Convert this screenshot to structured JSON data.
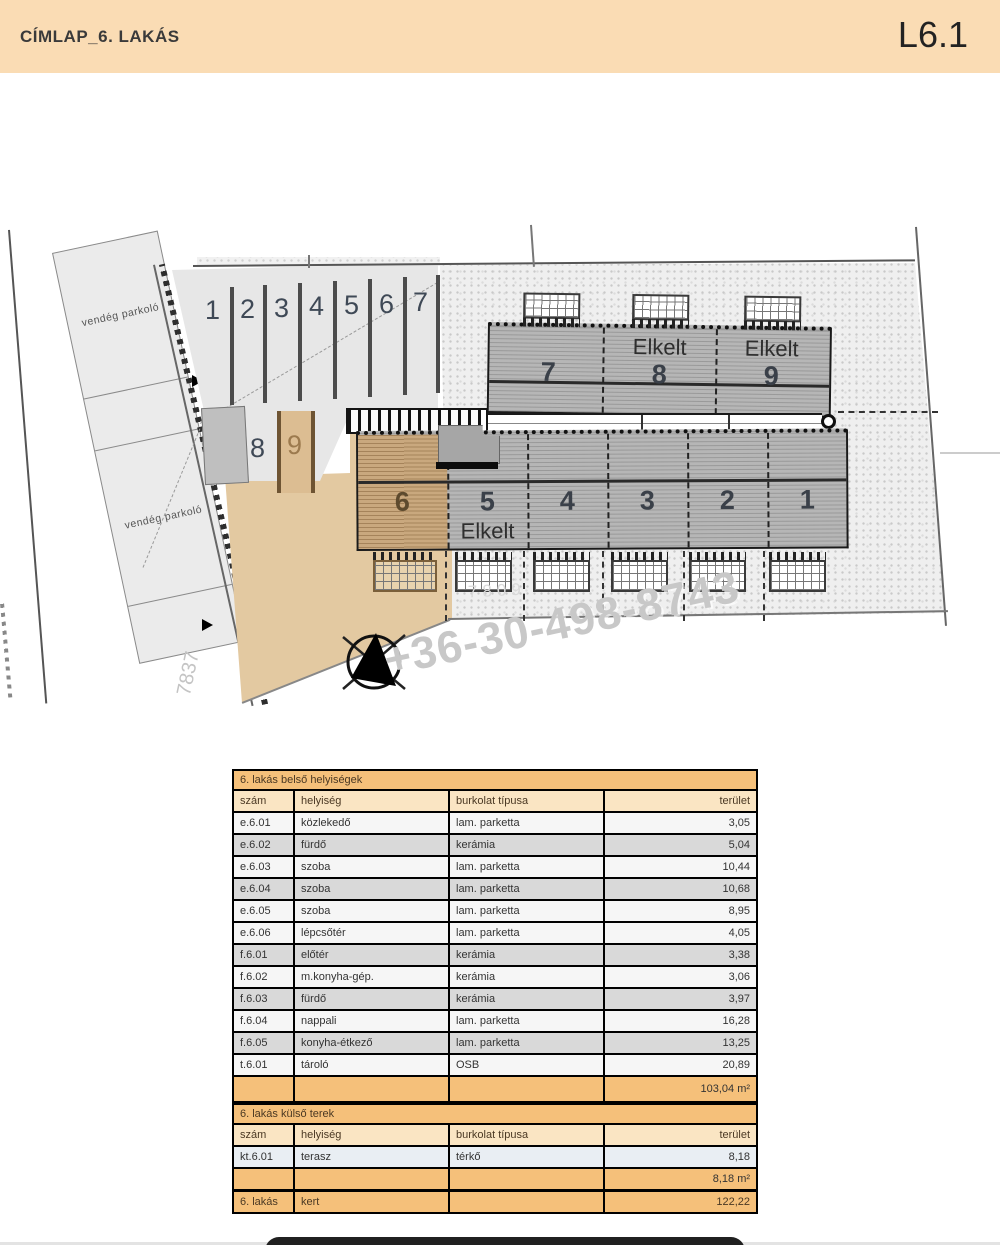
{
  "header": {
    "title": "CÍMLAP_6. LAKÁS",
    "sheet": "L6.1"
  },
  "plan": {
    "watermark": "+36-30-498-8743",
    "road_number": "7837",
    "parcel_number": "7809",
    "guest_parking_1": "vendég parkoló",
    "guest_parking_2": "vendég parkoló",
    "parking_numbers": [
      "1",
      "2",
      "3",
      "4",
      "5",
      "6",
      "7"
    ],
    "parking_spot_8": "8",
    "parking_spot_9": "9",
    "upper_units": [
      {
        "number": "7",
        "status": ""
      },
      {
        "number": "8",
        "status": "Elkelt"
      },
      {
        "number": "9",
        "status": "Elkelt"
      }
    ],
    "lower_units": [
      {
        "number": "6",
        "status": ""
      },
      {
        "number": "5",
        "status": "Elkelt"
      },
      {
        "number": "4",
        "status": ""
      },
      {
        "number": "3",
        "status": ""
      },
      {
        "number": "2",
        "status": ""
      },
      {
        "number": "1",
        "status": ""
      }
    ]
  },
  "tables": {
    "interior": {
      "title": "6. lakás belső helyiségek",
      "columns": [
        "szám",
        "helyiség",
        "burkolat típusa",
        "terület"
      ],
      "rows": [
        {
          "num": "e.6.01",
          "room": "közlekedő",
          "floor": "lam. parketta",
          "area": "3,05",
          "shade": "light"
        },
        {
          "num": "e.6.02",
          "room": "fürdő",
          "floor": "kerámia",
          "area": "5,04",
          "shade": "dark"
        },
        {
          "num": "e.6.03",
          "room": "szoba",
          "floor": "lam. parketta",
          "area": "10,44",
          "shade": "light"
        },
        {
          "num": "e.6.04",
          "room": "szoba",
          "floor": "lam. parketta",
          "area": "10,68",
          "shade": "dark"
        },
        {
          "num": "e.6.05",
          "room": "szoba",
          "floor": "lam. parketta",
          "area": "8,95",
          "shade": "light"
        },
        {
          "num": "e.6.06",
          "room": "lépcsőtér",
          "floor": "lam. parketta",
          "area": "4,05",
          "shade": "light"
        },
        {
          "num": "f.6.01",
          "room": "előtér",
          "floor": "kerámia",
          "area": "3,38",
          "shade": "dark"
        },
        {
          "num": "f.6.02",
          "room": "m.konyha-gép.",
          "floor": "kerámia",
          "area": "3,06",
          "shade": "light"
        },
        {
          "num": "f.6.03",
          "room": "fürdő",
          "floor": "kerámia",
          "area": "3,97",
          "shade": "dark"
        },
        {
          "num": "f.6.04",
          "room": "nappali",
          "floor": "lam. parketta",
          "area": "16,28",
          "shade": "light"
        },
        {
          "num": "f.6.05",
          "room": "konyha-étkező",
          "floor": "lam. parketta",
          "area": "13,25",
          "shade": "dark"
        },
        {
          "num": "t.6.01",
          "room": "tároló",
          "floor": "OSB",
          "area": "20,89",
          "shade": "light"
        }
      ],
      "total": "103,04 m²"
    },
    "exterior": {
      "title": "6. lakás külső terek",
      "columns": [
        "szám",
        "helyiség",
        "burkolat típusa",
        "terület"
      ],
      "rows": [
        {
          "num": "kt.6.01",
          "room": "terasz",
          "floor": "térkő",
          "area": "8,18",
          "shade": "blue"
        }
      ],
      "subtotal": "8,18 m²",
      "summary": {
        "num": "6. lakás",
        "room": "kert",
        "floor": "",
        "area": "122,22"
      }
    }
  },
  "colors": {
    "header_band": "#fadcb4",
    "table_title": "#f5c07a",
    "table_header": "#fae5c3",
    "building_gray": "#b6b6b6",
    "subject_unit_tan": "#c9a87e",
    "ground_tan": "#e3c9a1"
  }
}
